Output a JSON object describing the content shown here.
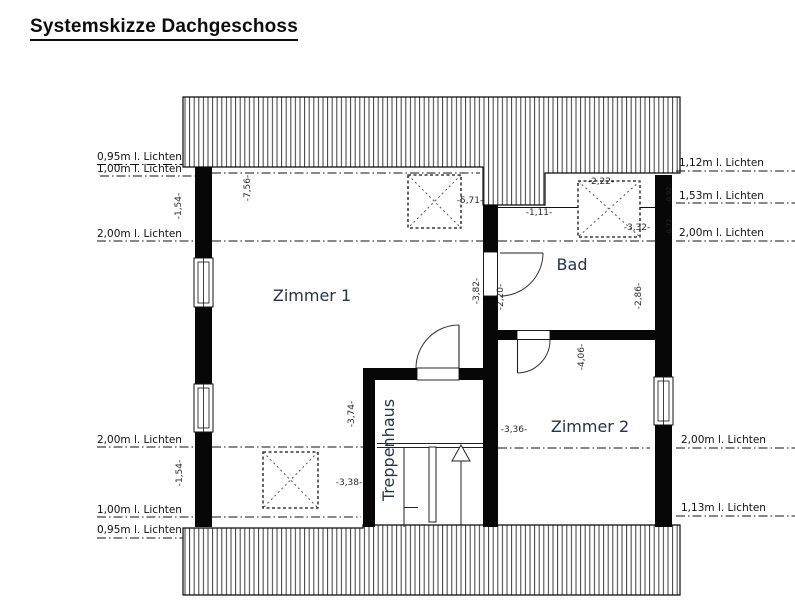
{
  "title": "Systemskizze Dachgeschoss",
  "rooms": {
    "zimmer1": "Zimmer 1",
    "bad": "Bad",
    "zimmer2": "Zimmer 2",
    "treppenhaus": "Treppenhaus"
  },
  "clearance_labels": {
    "left": [
      "0,95m l. Lichten",
      "1,00m l. Lichten",
      "2,00m l. Lichten",
      "2,00m l. Lichten",
      "1,00m l. Lichten",
      "0,95m l. Lichten"
    ],
    "right": [
      "1,12m l. Lichten",
      "1,53m l. Lichten",
      "2,00m l. Lichten",
      "2,00m l. Lichten",
      "1,13m l. Lichten"
    ]
  },
  "dimensions": {
    "zimmer1_width_top": "-7,56-",
    "knee_wall_left_top": "-1,54-",
    "rooflight1_offset": "-5,71-",
    "bad_recess_width": "-1,11-",
    "rooflight2_width": "-2,22-",
    "bad_width": "-3,32-",
    "zimmer1_depth_right": "-3,82-",
    "bad_door_wall": "-2,20-",
    "bad_depth_right": "-2,86-",
    "zimmer2_depth": "-4,06-",
    "treppenhaus_depth": "-3,74-",
    "zimmer2_width": "-3,36-",
    "rooflight3_width": "-3,38-",
    "knee_wall_left_bottom": "-1,54-",
    "wall_right_upper": "-0,92-",
    "wall_right_lower": "-0,72-"
  }
}
